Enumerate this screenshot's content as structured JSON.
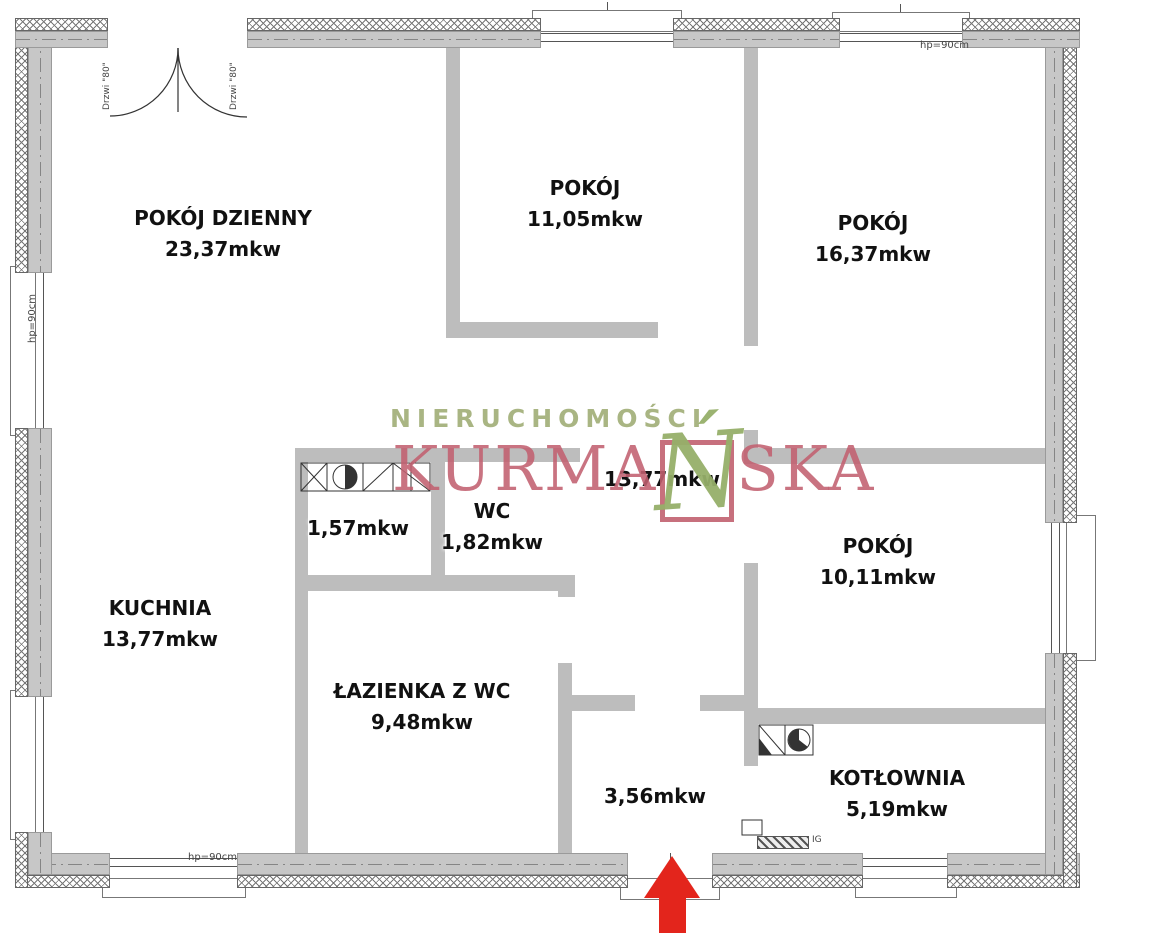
{
  "rooms": [
    {
      "name": "POKÓJ DZIENNY",
      "area": "23,37mkw"
    },
    {
      "name": "POKÓJ",
      "area": "11,05mkw"
    },
    {
      "name": "POKÓJ",
      "area": "16,37mkw"
    },
    {
      "name": "KUCHNIA",
      "area": "13,77mkw"
    },
    {
      "name": "",
      "area": "1,57mkw"
    },
    {
      "name": "WC",
      "area": "1,82mkw"
    },
    {
      "name": "",
      "area": "13,77mkw"
    },
    {
      "name": "POKÓJ",
      "area": "10,11mkw"
    },
    {
      "name": "ŁAZIENKA Z WC",
      "area": "9,48mkw"
    },
    {
      "name": "",
      "area": "3,56mkw"
    },
    {
      "name": "KOTŁOWNIA",
      "area": "5,19mkw"
    }
  ],
  "annotations": {
    "door_label": "Drzwi \"80\"",
    "window_label": "hp=90cm",
    "ig_label": "IG"
  },
  "watermark": {
    "line1": "NIERUCHOMOŚCI",
    "name_pre": "KURMA",
    "name_accent": "Ń",
    "name_post": "SKA"
  },
  "colors": {
    "interior_wall": "#bdbdbd",
    "exterior_wall_core": "#c7c7c7",
    "watermark_green": "#a9b583",
    "watermark_rose": "#c4606f",
    "entrance_arrow_red": "#e3251c"
  }
}
